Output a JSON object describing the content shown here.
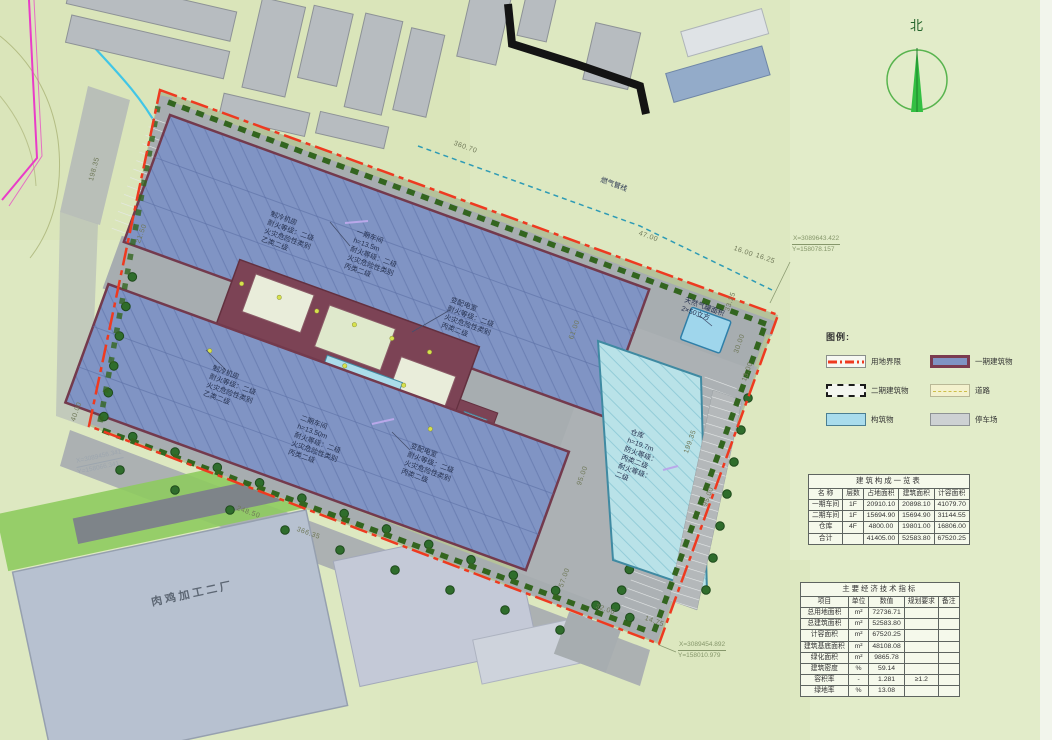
{
  "north": {
    "label": "北"
  },
  "legend": {
    "title": "图例:",
    "items": [
      {
        "label": "用地界限",
        "swatch": "boundary"
      },
      {
        "label": "一期建筑物",
        "swatch": "phase1"
      },
      {
        "label": "二期建筑物",
        "swatch": "phase2"
      },
      {
        "label": "道路",
        "swatch": "road"
      },
      {
        "label": "构筑物",
        "swatch": "structure"
      },
      {
        "label": "停车场",
        "swatch": "parking"
      }
    ]
  },
  "tables": {
    "building_table": {
      "title": "建筑构成一览表",
      "headers": [
        "名 称",
        "层数",
        "占地面积",
        "建筑面积",
        "计容面积"
      ],
      "rows": [
        [
          "一期车间",
          "1F",
          "20910.10",
          "20898.10",
          "41079.70"
        ],
        [
          "二期车间",
          "1F",
          "15694.90",
          "15694.90",
          "31144.55"
        ],
        [
          "仓库",
          "4F",
          "4800.00",
          "19801.00",
          "16806.00"
        ],
        [
          "合计",
          "",
          "41405.00",
          "52583.80",
          "67520.25"
        ]
      ]
    },
    "indicator_table": {
      "title": "主要经济技术指标",
      "headers": [
        "项目",
        "单位",
        "数值",
        "规划要求",
        "备注"
      ],
      "rows": [
        [
          "总用地面积",
          "m²",
          "72736.71",
          "",
          ""
        ],
        [
          "总建筑面积",
          "m²",
          "52583.80",
          "",
          ""
        ],
        [
          "计容面积",
          "m²",
          "67520.25",
          "",
          ""
        ],
        [
          "建筑基底面积",
          "m²",
          "48108.08",
          "",
          ""
        ],
        [
          "绿化面积",
          "m²",
          "9865.78",
          "",
          ""
        ],
        [
          "建筑密度",
          "%",
          "59.14",
          "",
          ""
        ],
        [
          "容积率",
          "-",
          "1.281",
          "≥1.2",
          ""
        ],
        [
          "绿地率",
          "%",
          "13.08",
          "",
          ""
        ]
      ]
    }
  },
  "annotations": {
    "chiller_top": "制冷机房\n耐火等级：二级\n火灾危险性类别\n乙类二级",
    "phase1": "一期车间\nh=13.5m\n耐火等级：二级\n火灾危险性类别\n丙类二级",
    "substation_top": "变配电室\n耐火等级：二级\n火灾危险性类别\n丙类二级",
    "chiller_bottom": "制冷机房\n耐火等级：二级\n火灾危险性类别\n乙类二级",
    "phase2": "二期车间\nh=13.50m\n耐火等级：二级\n火灾危险性类别\n丙类二级",
    "substation_bottom": "变配电室\n耐火等级：二级\n火灾危险性类别\n丙类二级",
    "warehouse": "仓库\nh=19.7m\n防火等级：\n丙类二级\n耐火等级：\n二级",
    "gas_tank": "天然气罐面积\n2×50立方",
    "gas_line": "燃气管线",
    "factory": "肉鸡加工二厂"
  },
  "dims": [
    "360.70",
    "47.00",
    "16.00",
    "16.25",
    "33.25",
    "30.00",
    "13.00",
    "199.35",
    "95.00",
    "32.00",
    "14.75",
    "248.50",
    "366.35",
    "40.00",
    "198.35",
    "21.50",
    "61.00",
    "95.00",
    "57.00"
  ],
  "coords": {
    "c1": {
      "x": "X=3089643.422",
      "y": "Y=158078.157"
    },
    "c2": {
      "x": "X=3089454.892",
      "y": "Y=158010.979"
    },
    "c3": {
      "x": "X=3089456.341",
      "y": "Y=158066.341"
    }
  },
  "colors": {
    "boundary_red": "#ee3a20",
    "phase1_roof": "#8094c4",
    "phase1_border": "#733a4d",
    "structure_blue": "#a9dcec",
    "warehouse_teal": "#b9e2e8",
    "road_gray": "#a7adb0",
    "hedge_green": "#33651f",
    "boundary_magenta": "#e93cc8",
    "stream_cyan": "#41c6e6",
    "north_green": "#33bf42"
  }
}
